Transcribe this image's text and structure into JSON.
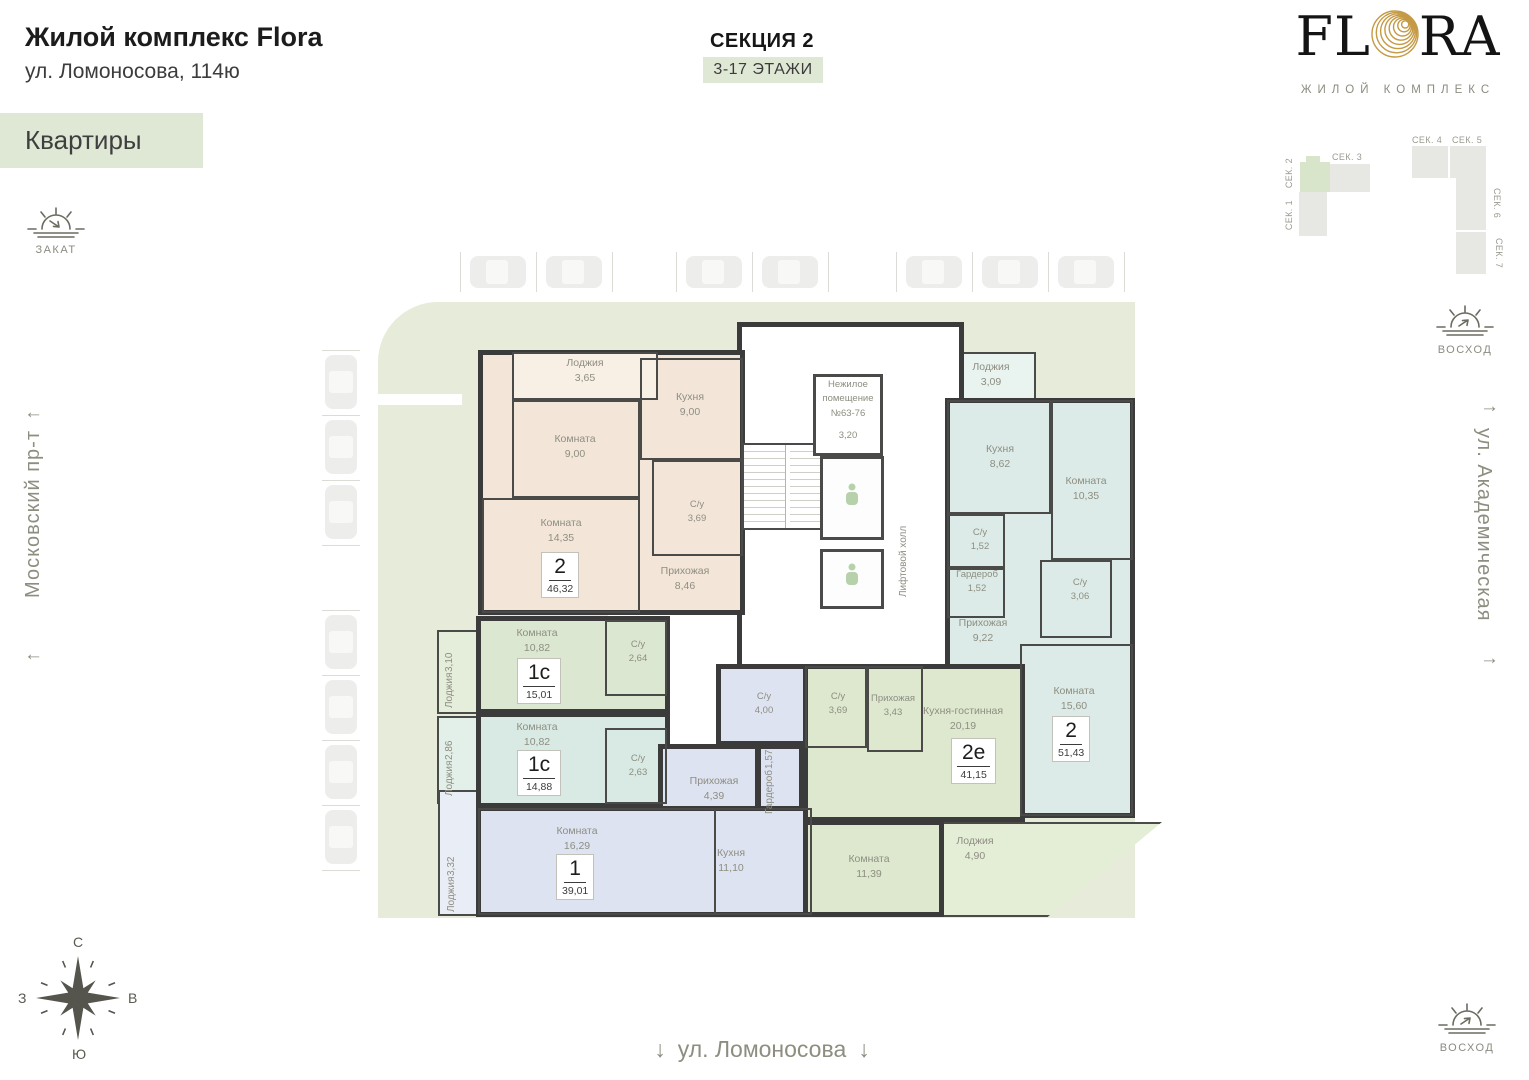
{
  "header": {
    "title": "Жилой комплекс Flora",
    "address": "ул. Ломоносова, 114ю",
    "tag": "Квартиры",
    "section_title": "СЕКЦИЯ 2",
    "floors": "3-17 ЭТАЖИ"
  },
  "logo": {
    "left": "FL",
    "right": "RA",
    "subtitle": "ЖИЛОЙ КОМПЛЕКС"
  },
  "site_plan": {
    "sek1": "СЕК. 1",
    "sek2": "СЕК. 2",
    "sek3": "СЕК. 3",
    "sek4": "СЕК. 4",
    "sek5": "СЕК. 5",
    "sek6": "СЕК. 6",
    "sek7": "СЕК. 7",
    "highlighted": "СЕК. 2",
    "highlight_color": "#d8e5ca"
  },
  "sun": {
    "zakat": "ЗАКАТ",
    "voshod": "ВОСХОД"
  },
  "streets": {
    "left": "Московский пр-т",
    "right": "ул. Академическая",
    "bottom": "ул. Ломоносова"
  },
  "arrows": {
    "left": "←",
    "right": "→",
    "down": "↓"
  },
  "compass": {
    "n": "С",
    "e": "В",
    "s": "Ю",
    "w": "З"
  },
  "colors": {
    "accent_green": "#dfe8d4",
    "landscape": "#e6ecd9",
    "wall": "#3b3b3b",
    "apt_beige": "#f3e6d8",
    "apt_teal": "#dcebe7",
    "apt_green": "#dbe7d0",
    "apt_mint": "#d8eae3",
    "apt_blue": "#dde3f1",
    "apt_green2e": "#dde8cf",
    "logo_gold": "#c49a44"
  },
  "plan": {
    "core": {
      "nonres_1": "Нежилое",
      "nonres_2": "помещение",
      "nonres_3": "№63-76",
      "nonres_area": "3,20",
      "lift_hall": "Лифтовой холл"
    },
    "beige": {
      "badge_type": "2",
      "badge_area": "46,32",
      "loggia": {
        "name": "Лоджия",
        "area": "3,65"
      },
      "room1": {
        "name": "Комната",
        "area": "9,00"
      },
      "kitchen": {
        "name": "Кухня",
        "area": "9,00"
      },
      "room2": {
        "name": "Комната",
        "area": "14,35"
      },
      "bath": {
        "name": "С/у",
        "area": "3,69"
      },
      "hall": {
        "name": "Прихожая",
        "area": "8,46"
      }
    },
    "teal": {
      "badge_type": "2",
      "badge_area": "51,43",
      "loggia": {
        "name": "Лоджия",
        "area": "3,09"
      },
      "kitchen": {
        "name": "Кухня",
        "area": "8,62"
      },
      "room1": {
        "name": "Комната",
        "area": "10,35"
      },
      "su1": {
        "name": "С/у",
        "area": "1,52"
      },
      "wardrobe": {
        "name": "Гардероб",
        "area": "1,52"
      },
      "su2": {
        "name": "С/у",
        "area": "3,06"
      },
      "hall": {
        "name": "Прихожая",
        "area": "9,22"
      },
      "room2": {
        "name": "Комната",
        "area": "15,60"
      }
    },
    "studio1": {
      "badge_type": "1с",
      "badge_area": "15,01",
      "room": {
        "name": "Комната",
        "area": "10,82"
      },
      "su": {
        "name": "С/у",
        "area": "2,64"
      },
      "loggia": {
        "name": "Лоджия",
        "area": "3,10"
      }
    },
    "studio2": {
      "badge_type": "1с",
      "badge_area": "14,88",
      "room": {
        "name": "Комната",
        "area": "10,82"
      },
      "su": {
        "name": "С/у",
        "area": "2,63"
      },
      "loggia": {
        "name": "Лоджия",
        "area": "2,86"
      }
    },
    "blue": {
      "badge_type": "1",
      "badge_area": "39,01",
      "su": {
        "name": "С/у",
        "area": "4,00"
      },
      "wardrobe": {
        "name": "Гардероб",
        "area": "1,57"
      },
      "hall": {
        "name": "Прихожая",
        "area": "4,39"
      },
      "room": {
        "name": "Комната",
        "area": "16,29"
      },
      "kitchen": {
        "name": "Кухня",
        "area": "11,10"
      },
      "loggia": {
        "name": "Лоджия",
        "area": "3,32"
      }
    },
    "green2e": {
      "badge_type": "2е",
      "badge_area": "41,15",
      "su": {
        "name": "С/у",
        "area": "3,69"
      },
      "hall": {
        "name": "Прихожая",
        "area": "3,43"
      },
      "kitchen_living": {
        "name": "Кухня-гостинная",
        "area": "20,19"
      },
      "room": {
        "name": "Комната",
        "area": "11,39"
      },
      "loggia": {
        "name": "Лоджия",
        "area": "4,90"
      }
    }
  }
}
